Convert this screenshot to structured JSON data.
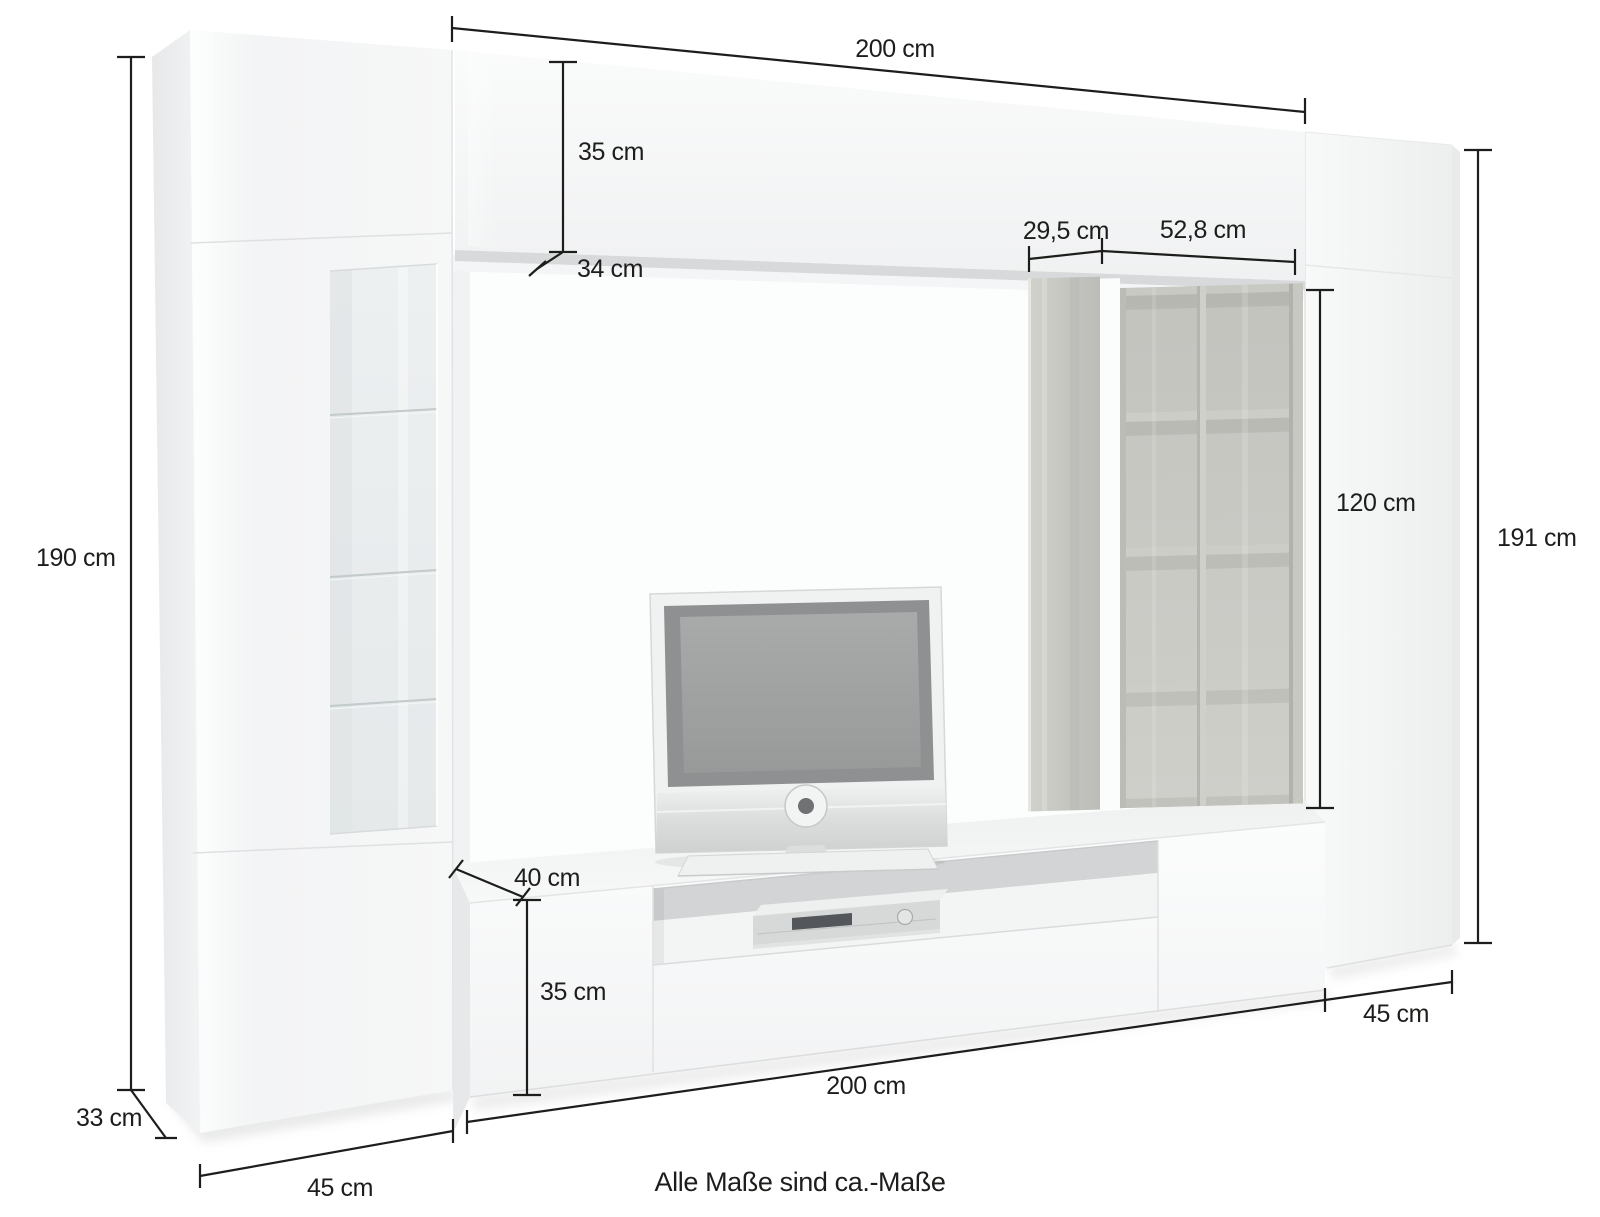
{
  "page": {
    "background": "#ffffff",
    "footnote": "Alle Maße sind ca.-Maße"
  },
  "colors": {
    "dimension_line": "#1d1d1b",
    "white_gloss_front": "#f7f8f8",
    "concrete_shelf": "#c9c9c4",
    "glass": "#ebeff0",
    "tv_screen_gray": "#a2a4a4"
  },
  "dimensions": {
    "top_width": "200 cm",
    "top_cabinet_height": "35 cm",
    "top_cabinet_depth": "34 cm",
    "shelf_panel_width": "29,5 cm",
    "shelf_grid_width": "52,8 cm",
    "left_cabinet_height": "190 cm",
    "shelf_unit_height": "120 cm",
    "right_cabinet_height": "191 cm",
    "lowboard_depth": "40 cm",
    "lowboard_height": "35 cm",
    "lowboard_width": "200 cm",
    "right_cabinet_width": "45 cm",
    "left_cabinet_width": "45 cm",
    "left_cabinet_depth": "33 cm"
  }
}
